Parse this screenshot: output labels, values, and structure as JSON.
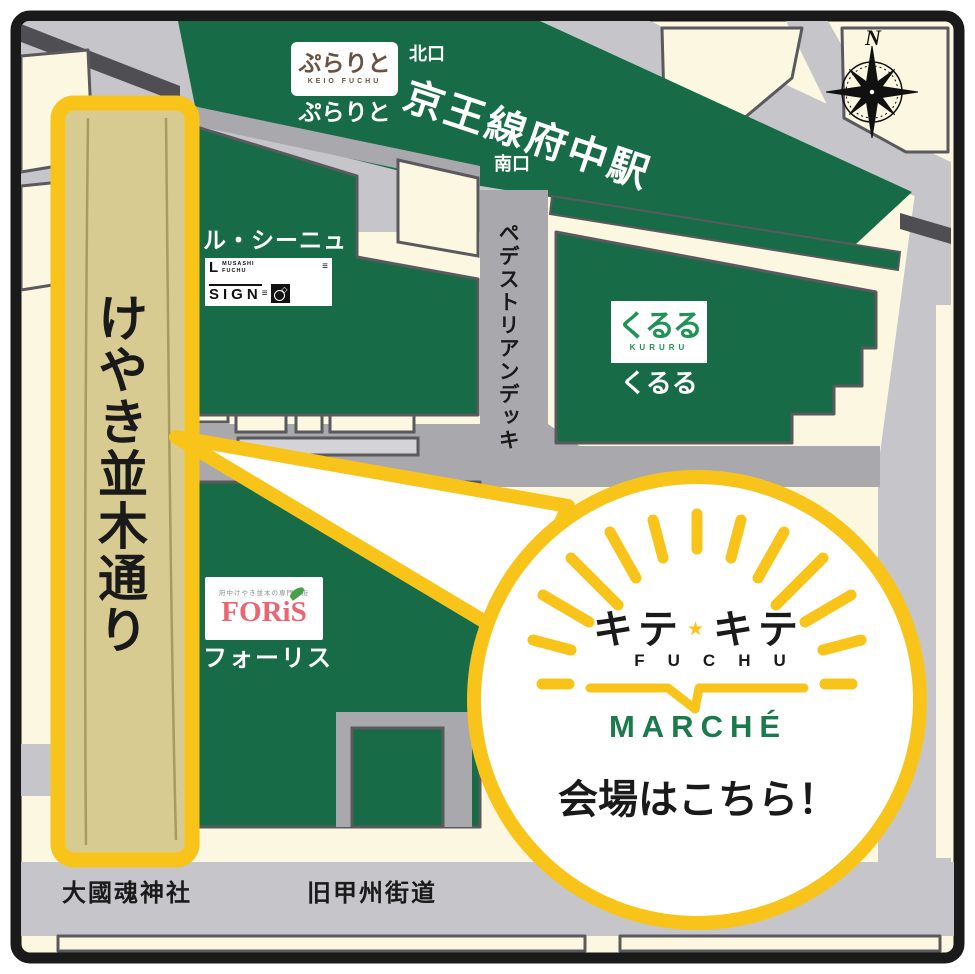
{
  "title": "Keio Fuchu Station area guide map",
  "station": {
    "name": "京王線府中駅",
    "north_exit": "北口",
    "south_exit": "南口"
  },
  "purarito": {
    "logo": "ぷらりと",
    "logo_sub": "KEIO FUCHU",
    "label": "ぷらりと"
  },
  "le_signe": {
    "label": "ル・シーニュ",
    "logo_l": "L",
    "logo_sub1": "MUSASHI",
    "logo_sub2": "FUCHU",
    "logo_sign": "SIGN",
    "logo_bars": "≡",
    "logo_diamond": "◇"
  },
  "kururu": {
    "logo": "くるる",
    "logo_sub": "KURURU",
    "label": "くるる"
  },
  "foris": {
    "logo_top": "府中けやき並木の専門店街",
    "logo": "FORiS",
    "label": "フォーリス"
  },
  "streets": {
    "keyaki": "けやき並木通り",
    "deck": "ペデストリアンデッキ",
    "koshu": "旧甲州街道",
    "shrine": "大國魂神社"
  },
  "compass": {
    "north": "N"
  },
  "callout": {
    "kite_left": "キテ",
    "star": "★",
    "kite_right": "キテ",
    "fuchu": "FUCHU",
    "marche": "MARCHÉ",
    "venue": "会場はこちら！"
  },
  "colors": {
    "building_green": "#176c47",
    "accent_yellow": "#f9c41a",
    "cream": "#fbf7e0",
    "street_tan": "#d8cb92",
    "road_gray": "#c6c6ca",
    "deck_gray": "#a9a9ad",
    "outline_gray": "#5a5a5e",
    "rail_dark": "#4f4f53",
    "marche_green": "#1b7a4c",
    "foris_red": "#ea6471",
    "purarito_brown": "#6b5240",
    "kururu_green": "#1f9257"
  }
}
